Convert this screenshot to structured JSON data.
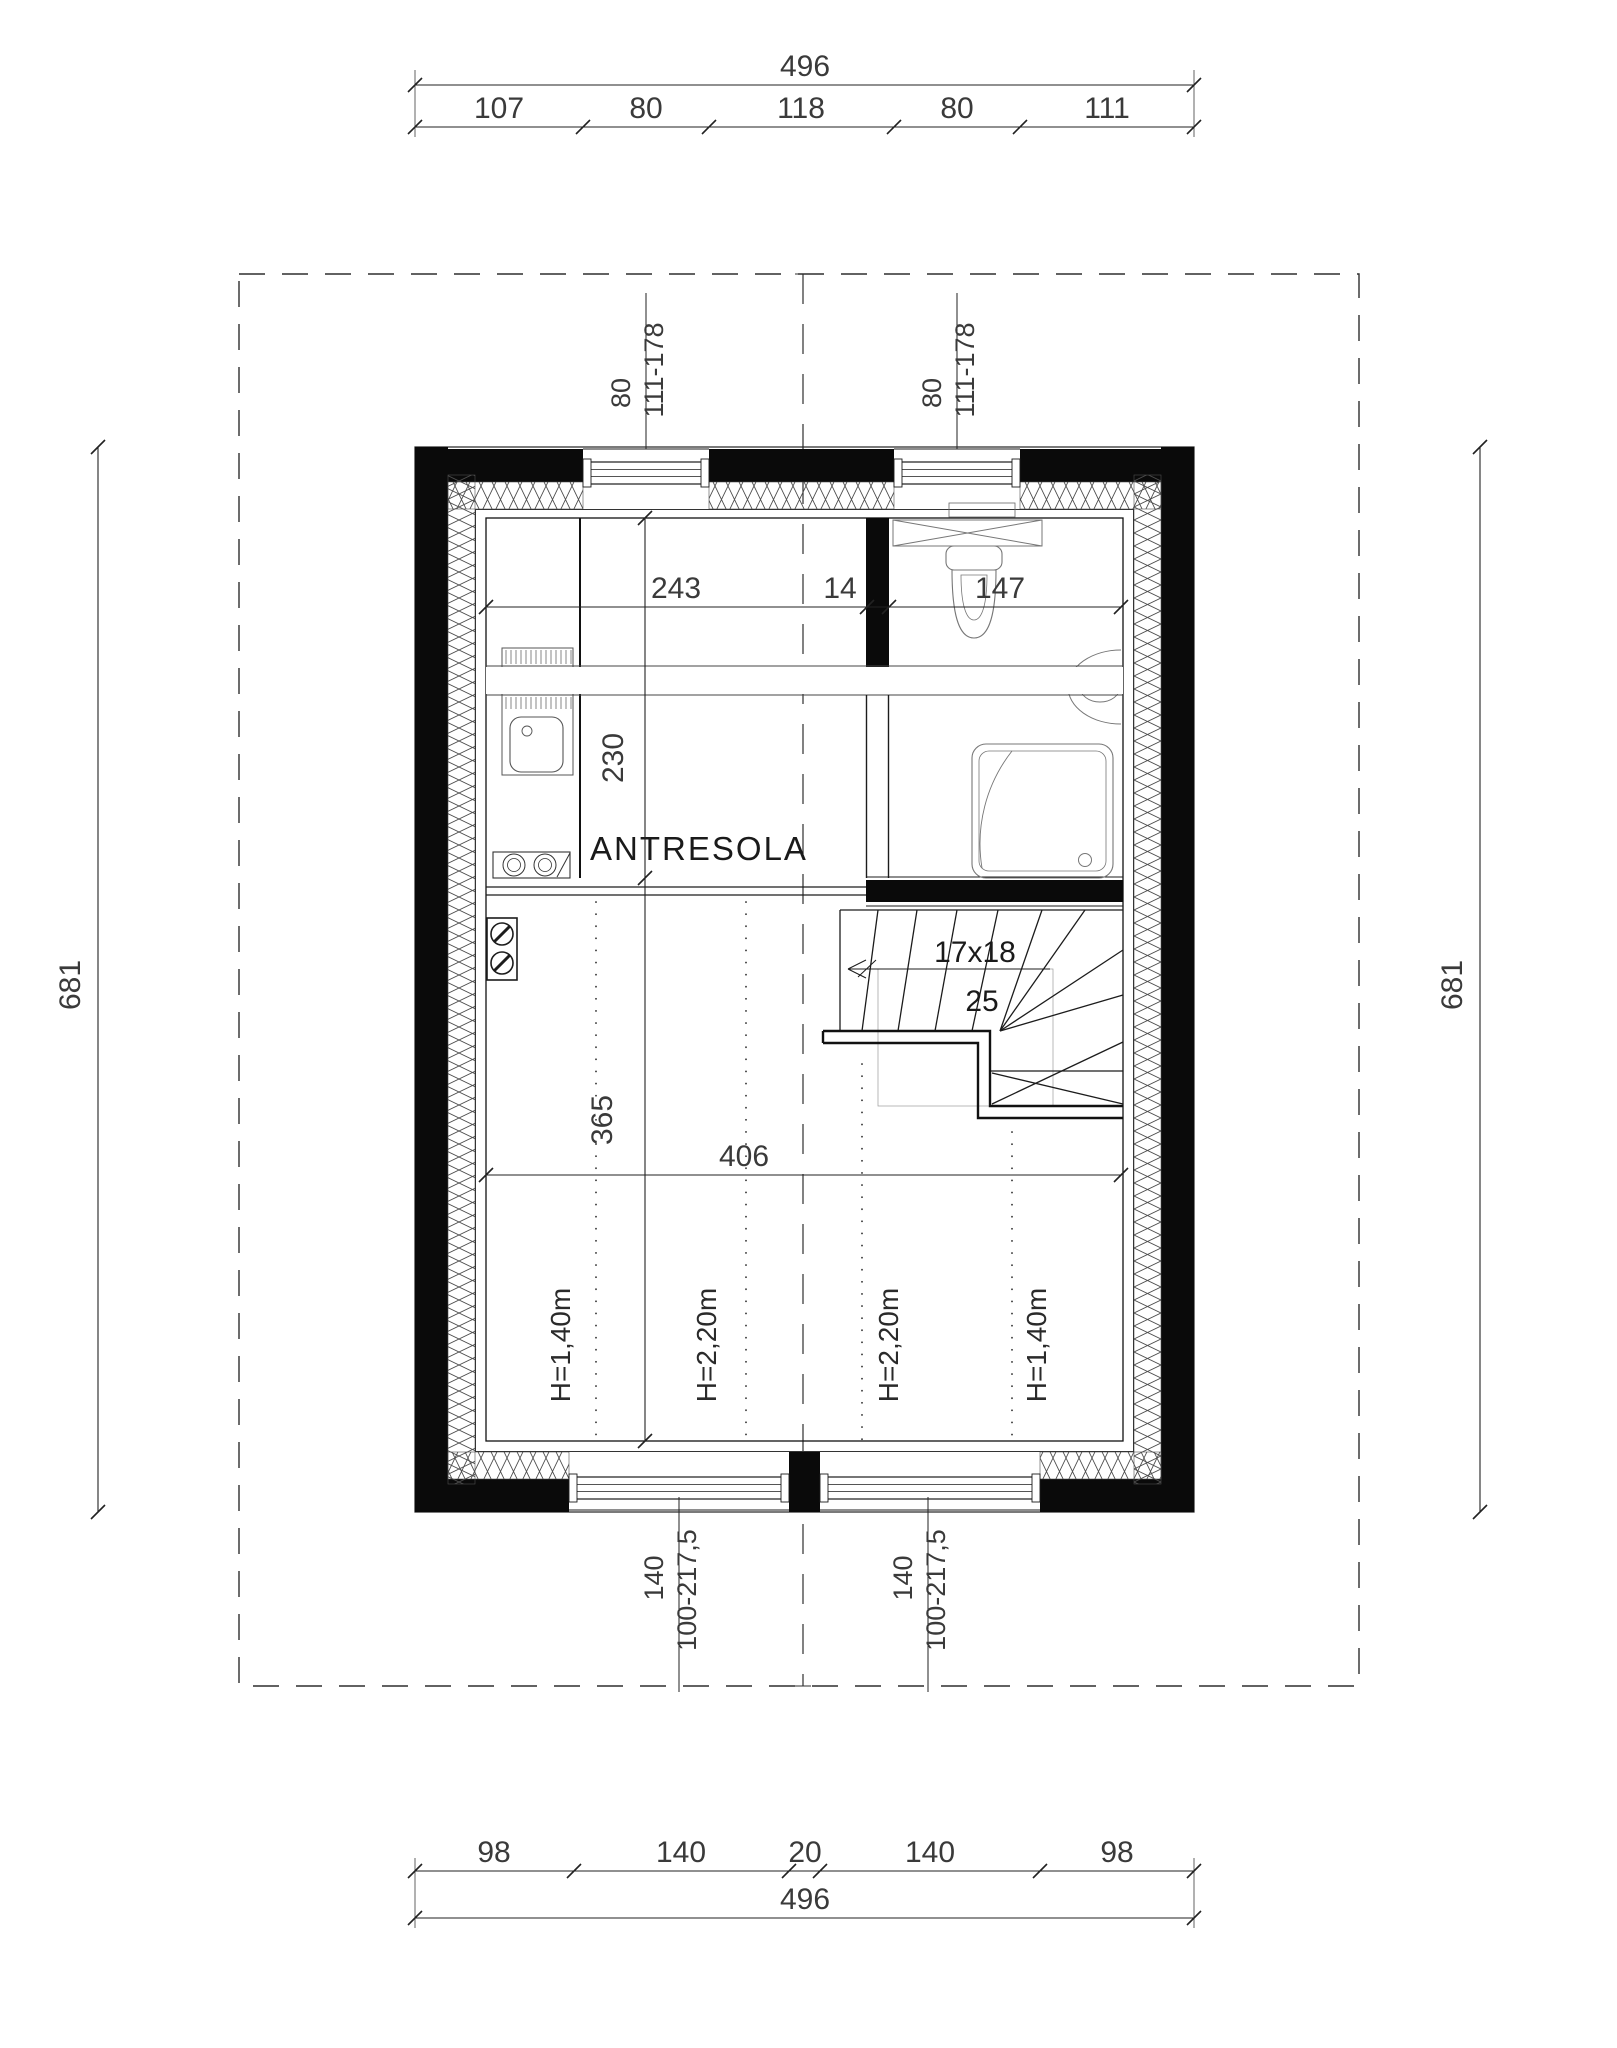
{
  "drawing": {
    "type": "floor-plan",
    "room_label": "ANTRESOLA"
  },
  "dims": {
    "top_total": "496",
    "top_segments": [
      "107",
      "80",
      "118",
      "80",
      "111"
    ],
    "bottom_segments": [
      "98",
      "140",
      "20",
      "140",
      "98"
    ],
    "bottom_total": "496",
    "left_total": "681",
    "right_total": "681",
    "upper_width_left": "243",
    "upper_width_wall": "14",
    "upper_width_bath": "147",
    "mezz_depth": "230",
    "lower_depth": "365",
    "interior_width": "406"
  },
  "windows": {
    "top1_w": "80",
    "top1_h": "111-178",
    "top2_w": "80",
    "top2_h": "111-178",
    "bot1_w": "140",
    "bot1_h": "100-217,5",
    "bot2_w": "140",
    "bot2_h": "100-217,5"
  },
  "stairs": {
    "steps": "17x18",
    "width": "25"
  },
  "heights": [
    "H=1,40m",
    "H=2,20m",
    "H=2,20m",
    "H=1,40m"
  ],
  "colors": {
    "wall": "#0a0a0a",
    "line": "#1c1c1c",
    "dim_text": "#3a3a3a",
    "background": "#ffffff"
  }
}
